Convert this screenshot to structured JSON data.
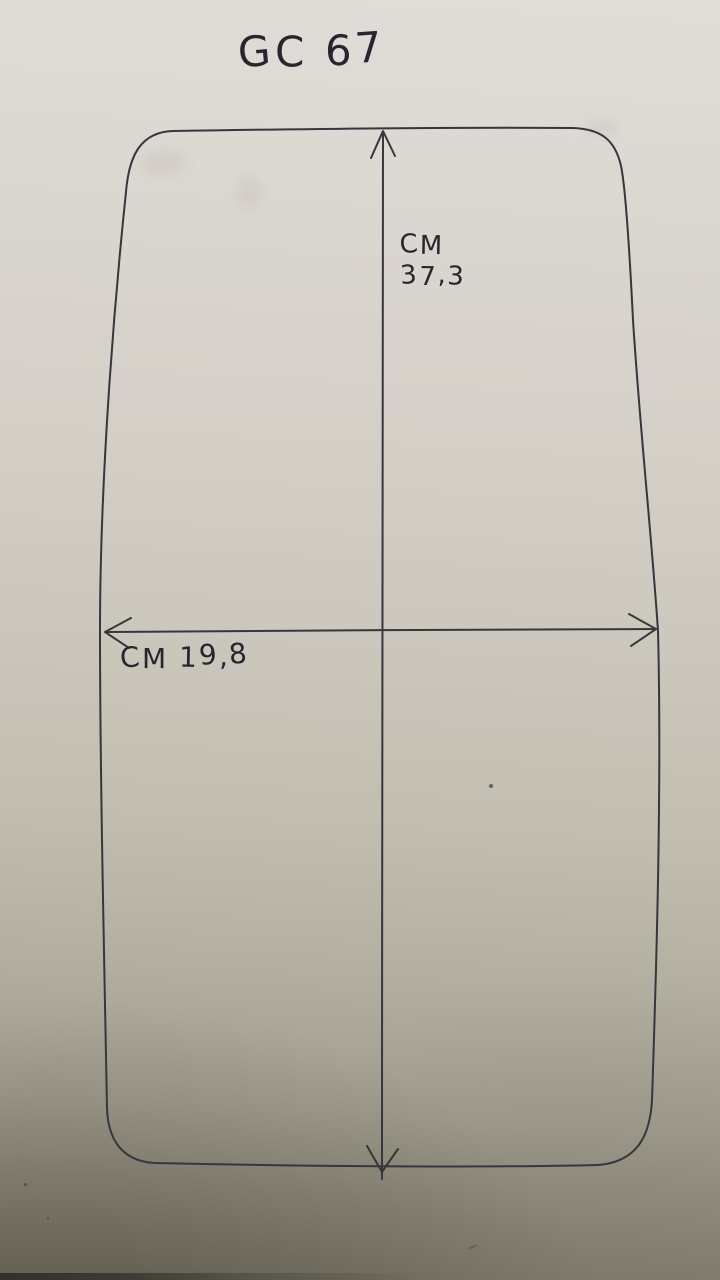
{
  "labels": {
    "title": "GC 67",
    "height_unit": "CM",
    "height_value": "37,3",
    "width_label": "CM 19,8"
  },
  "drawing": {
    "shape": "rounded-rectangle-outline",
    "vertical_dimension": {
      "unit": "CM",
      "value": "37,3"
    },
    "horizontal_dimension": {
      "unit": "CM",
      "value": "19,8"
    }
  },
  "colors": {
    "ink": "#36363d",
    "paper_top": "#e0dcd7",
    "paper_bottom": "#7a7567",
    "table_edge": "#32302a"
  }
}
